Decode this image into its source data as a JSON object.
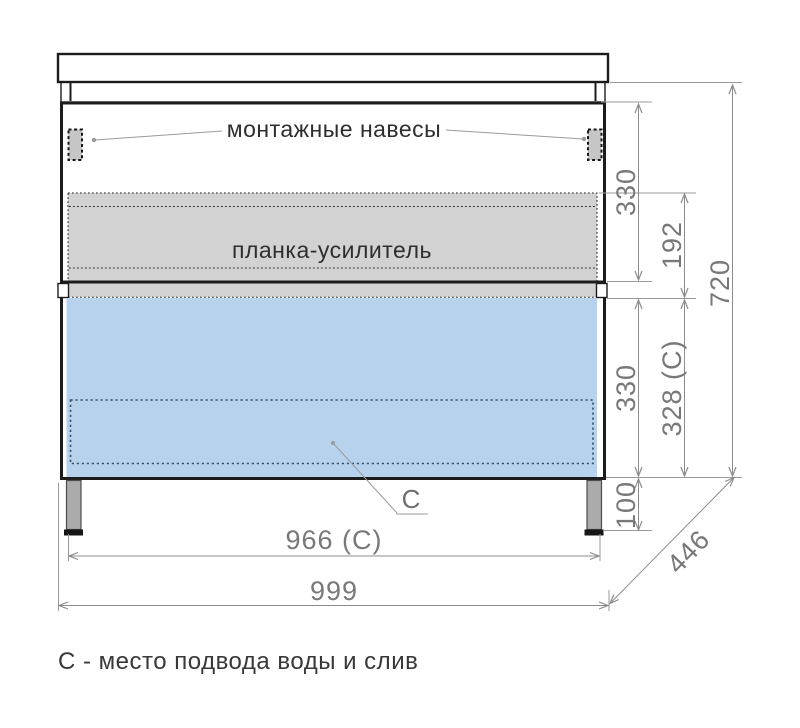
{
  "drawing": {
    "type": "furniture-technical-drawing",
    "subject": "vanity cabinet front view with dimensions"
  },
  "labels": {
    "mounting_hangers": "монтажные навесы",
    "reinforcement_strip": "планка-усилитель",
    "c_marker": "C",
    "caption": "С - место подвода воды и слив"
  },
  "dimensions": {
    "upper_330": "330",
    "strip_192": "192",
    "lower_330": "330",
    "lower_328c": "328 (C)",
    "height_720": "720",
    "legs_100": "100",
    "width_966c": "966 (C)",
    "width_999": "999",
    "depth_446": "446"
  },
  "colors": {
    "drawer_highlight": "#b7d2ec",
    "panel_gray": "#d2d2d2",
    "hanger_gray": "#c6c6c6",
    "leg_gray": "#ababab",
    "furniture_line": "#1c1c1c",
    "dimension_line": "#8c8c8c",
    "dimension_text": "#787878",
    "service_outline": "#3c4f68"
  }
}
